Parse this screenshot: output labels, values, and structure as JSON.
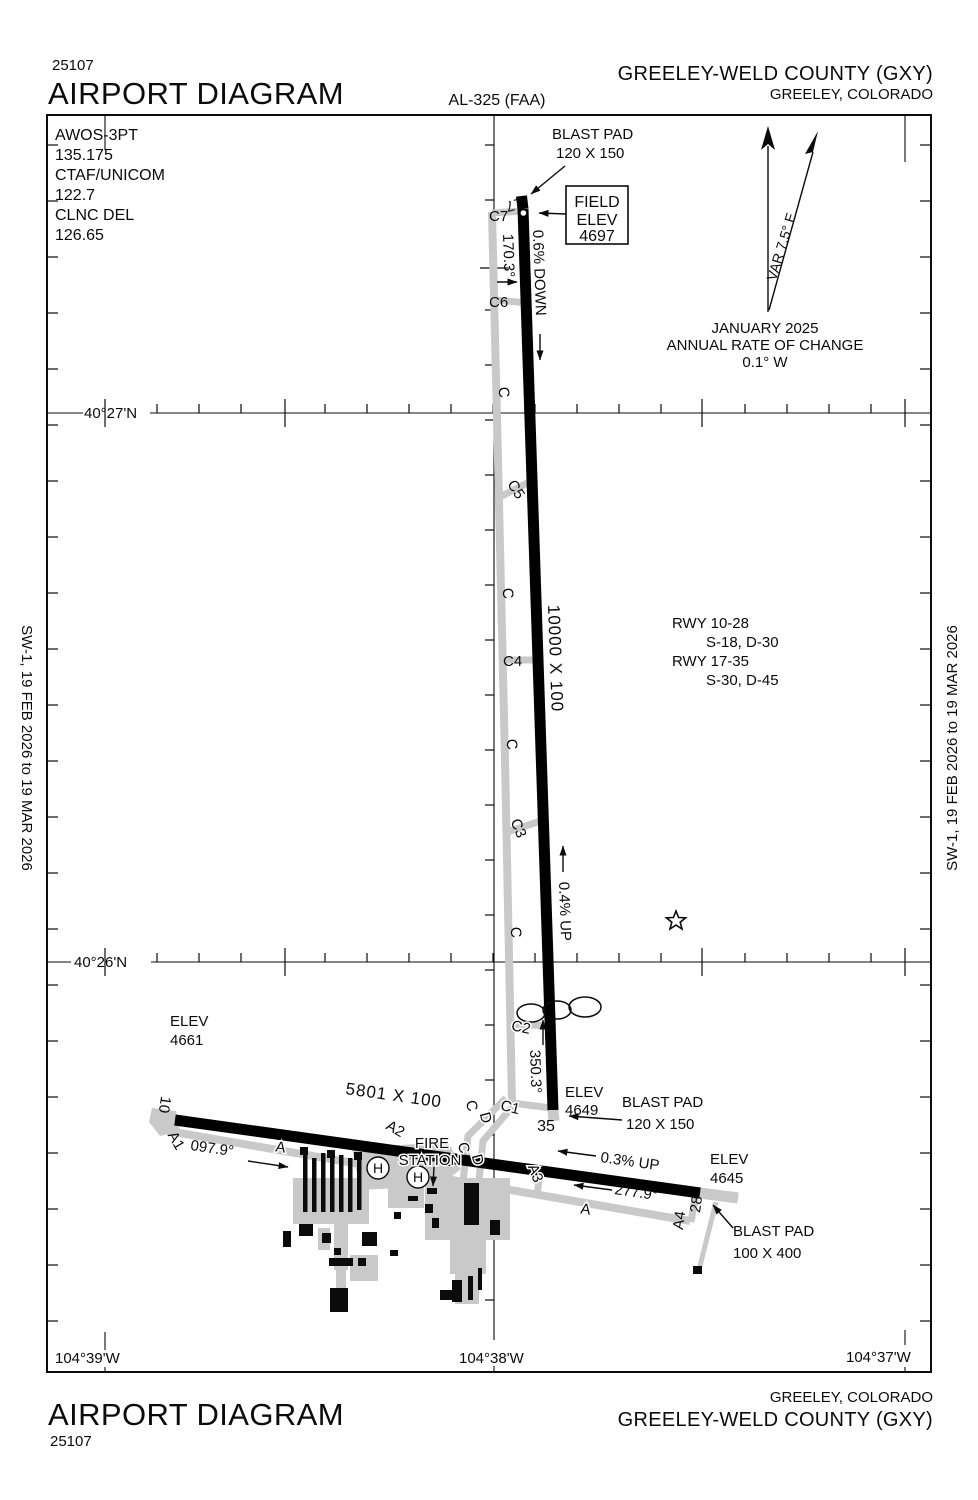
{
  "colors": {
    "background": "#ffffff",
    "runway": "#000000",
    "taxiway": "#c9c9c9"
  },
  "header": {
    "chart_number": "25107",
    "title": "AIRPORT DIAGRAM",
    "procedure_id": "AL-325 (FAA)",
    "airport_name": "GREELEY-WELD COUNTY (GXY)",
    "city": "GREELEY, COLORADO"
  },
  "footer": {
    "title": "AIRPORT DIAGRAM",
    "chart_number": "25107",
    "city": "GREELEY, COLORADO",
    "airport_name": "GREELEY-WELD COUNTY (GXY)"
  },
  "effective_dates": "SW-1,  19 FEB 2026  to  19 MAR 2026",
  "comm": {
    "line1": "AWOS-3PT",
    "line2": "135.175",
    "line3": "CTAF/UNICOM",
    "line4": "122.7",
    "line5": "CLNC DEL",
    "line6": "126.65"
  },
  "north": {
    "variation": "VAR 7.5° E",
    "date": "JANUARY 2025",
    "rate_label": "ANNUAL RATE OF CHANGE",
    "rate_value": "0.1° W"
  },
  "field_elev": {
    "line1": "FIELD",
    "line2": "ELEV",
    "value": "4697"
  },
  "graticule": {
    "lat_n": "40°27'N",
    "lat_s": "40°26'N",
    "lon_w": "104°39'W",
    "lon_c": "104°38'W",
    "lon_e": "104°37'W"
  },
  "runway_data": {
    "r1": "RWY 10-28",
    "r1_strength": "S-18, D-30",
    "r2": "RWY 17-35",
    "r2_strength": "S-30, D-45"
  },
  "rwy1735": {
    "num_n": "17",
    "num_s": "35",
    "size": "10000 X 100",
    "hdg_n": "170.3°",
    "hdg_s": "350.3°",
    "slope_n": "0.6% DOWN",
    "slope_s": "0.4% UP",
    "elev_s_label": "ELEV",
    "elev_s": "4649",
    "bp_n1": "BLAST PAD",
    "bp_n2": "120 X 150",
    "bp_s1": "BLAST PAD",
    "bp_s2": "120 X 150"
  },
  "rwy1028": {
    "num_w": "10",
    "num_e": "28",
    "size": "5801 X 100",
    "hdg_w": "097.9°",
    "hdg_e": "277.9°",
    "slope": "0.3% UP",
    "elev_w_label": "ELEV",
    "elev_w": "4661",
    "elev_e_label": "ELEV",
    "elev_e": "4645",
    "bp_e1": "BLAST PAD",
    "bp_e2": "100 X 400"
  },
  "taxiways": {
    "a": "A",
    "c": "C",
    "d": "D",
    "a1": "A1",
    "a2": "A2",
    "a3": "A3",
    "a4": "A4",
    "c1": "C1",
    "c2": "C2",
    "c3": "C3",
    "c4": "C4",
    "c5": "C5",
    "c6": "C6",
    "c7": "C7"
  },
  "facilities": {
    "fire1": "FIRE",
    "fire2": "STATION",
    "helipad": "H"
  }
}
